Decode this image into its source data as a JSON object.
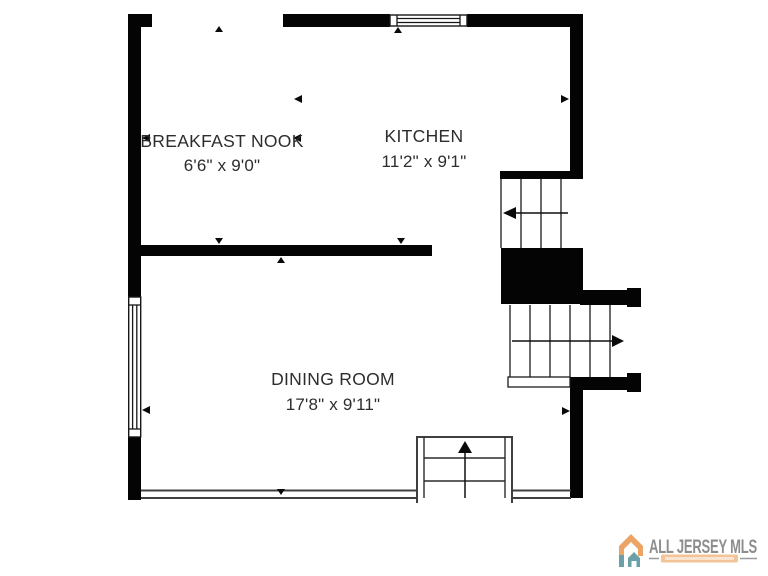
{
  "floor_plan": {
    "rooms": [
      {
        "name": "BREAKFAST NOOK",
        "dimensions": "6'6\" x 9'0\""
      },
      {
        "name": "KITCHEN",
        "dimensions": "11'2\" x 9'1\""
      },
      {
        "name": "DINING ROOM",
        "dimensions": "17'8\" x 9'11\""
      }
    ]
  },
  "branding": {
    "name": "ALL JERSEY MLS",
    "colors": {
      "accent_orange": "#ECA466",
      "accent_teal": "#6AA0A8",
      "text_gray": "#8D8D8D",
      "tagline_band": "#F3C497",
      "dash_gray": "#9A9A9A"
    }
  }
}
